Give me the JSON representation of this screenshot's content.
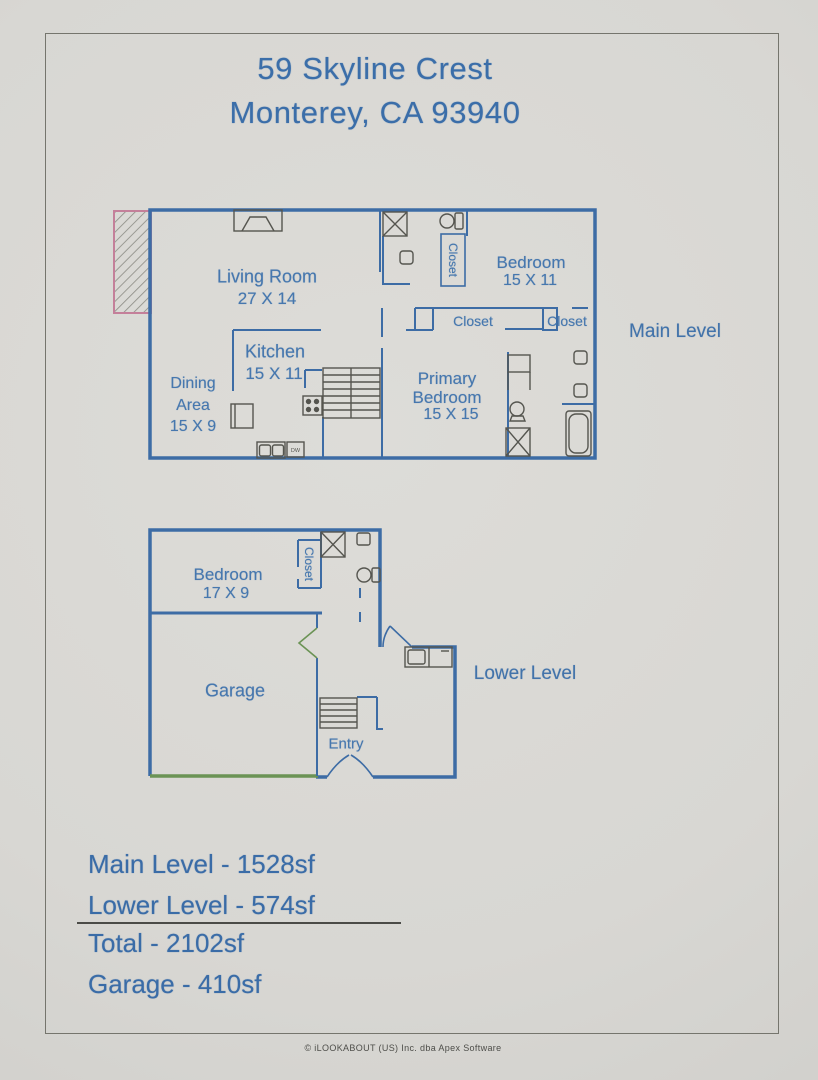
{
  "page": {
    "title_line1": "59 Skyline Crest",
    "title_line2": "Monterey, CA 93940",
    "footer": "© iLOOKABOUT (US) Inc. dba Apex Software"
  },
  "main_level": {
    "label": "Main Level",
    "living_room": {
      "name": "Living Room",
      "dims": "27 X 14"
    },
    "kitchen": {
      "name": "Kitchen",
      "dims": "15 X 11"
    },
    "dining_area": {
      "name_line1": "Dining",
      "name_line2": "Area",
      "dims": "15 X 9"
    },
    "bedroom": {
      "name": "Bedroom",
      "dims": "15 X 11"
    },
    "primary_bedroom": {
      "name_line1": "Primary",
      "name_line2": "Bedroom",
      "dims": "15 X 15"
    },
    "closet_bath": "Closet",
    "closet_hall_left": "Closet",
    "closet_hall_right": "Closet",
    "dishwasher": "DW"
  },
  "lower_level": {
    "label": "Lower Level",
    "bedroom": {
      "name": "Bedroom",
      "dims": "17 X 9"
    },
    "garage": {
      "name": "Garage"
    },
    "entry": {
      "name": "Entry"
    },
    "closet": "Closet"
  },
  "summary": {
    "main_level": "Main Level - 1528sf",
    "lower_level": "Lower Level - 574sf",
    "total": "Total - 2102sf",
    "garage": "Garage - 410sf"
  },
  "colors": {
    "wall_blue": "#3d6ca5",
    "label_blue": "#4677ae",
    "fixture_gray": "#55554f",
    "garage_green": "#6b9355",
    "deck_pink": "#c4809a",
    "paper": "#d8d7d3"
  }
}
